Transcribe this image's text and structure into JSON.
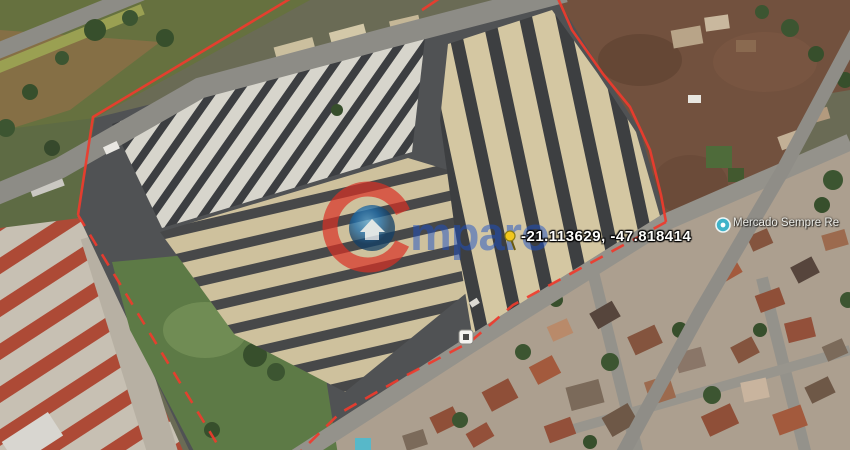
{
  "map": {
    "watermark": {
      "text": "mparo",
      "ring_color": "#d93025",
      "disc_color": "#1e6fae",
      "text_color": "#1b50c8"
    },
    "pin_label": {
      "text": "-21.113629, -47.818414",
      "icon": "pushpin-icon",
      "pin_color": "#f2c71c"
    },
    "poi": {
      "label": "Mercado Sempre Re",
      "icon": "poi-marker-icon",
      "marker_color": "#3fb3c9"
    },
    "boundary": {
      "color": "#ef3b2d"
    },
    "road_badge": {
      "icon": "road-sign-badge"
    }
  }
}
